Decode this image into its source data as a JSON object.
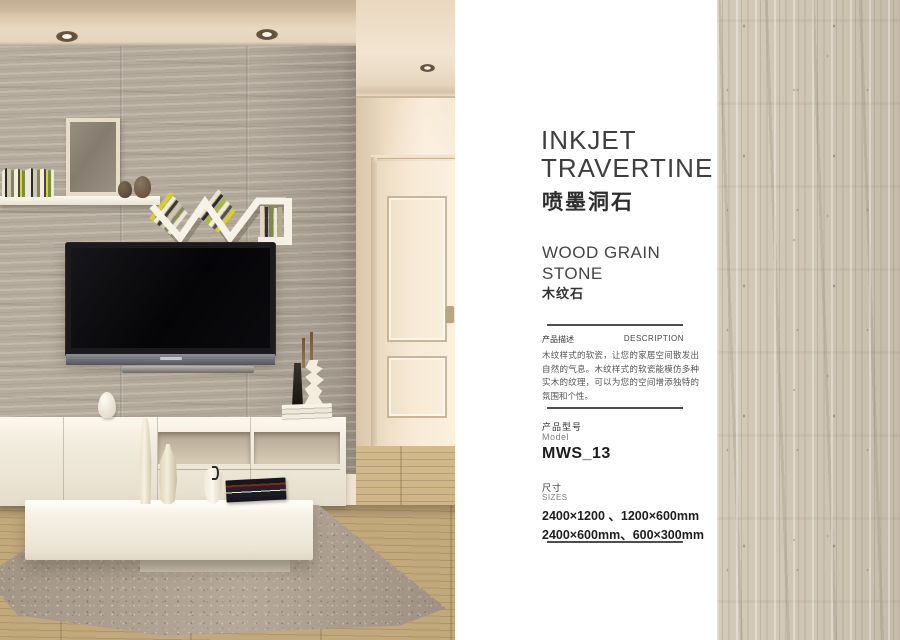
{
  "info_panel": {
    "title_en_line1": "INKJET",
    "title_en_line2": "TRAVERTINE",
    "title_cn": "喷墨洞石",
    "category_en_line1": "WOOD GRAIN",
    "category_en_line2": "STONE",
    "category_cn": "木纹石",
    "description": {
      "label_cn": "产品描述",
      "label_en": "DESCRIPTION",
      "body_cn": "木纹样式的软瓷，让您的家居空间散发出自然的气息。木纹样式的软瓷能模仿多种实木的纹理，可以为您的空间增添独特的氛围和个性。"
    },
    "model": {
      "label_cn": "产品型号",
      "label_en": "Model",
      "value": "MWS_13"
    },
    "sizes": {
      "label_cn": "尺寸",
      "label_en": "SIZES",
      "line1": "2400×1200 、1200×600mm",
      "line2": "2400×600mm、600×300mm"
    }
  },
  "colors": {
    "tile_wall": "#b2a89a",
    "texture_swatch": "#cdc3b2",
    "wood_floor": "#c9b083",
    "rug": "#ab9e8f",
    "heading_text": "#3e3e3e"
  }
}
